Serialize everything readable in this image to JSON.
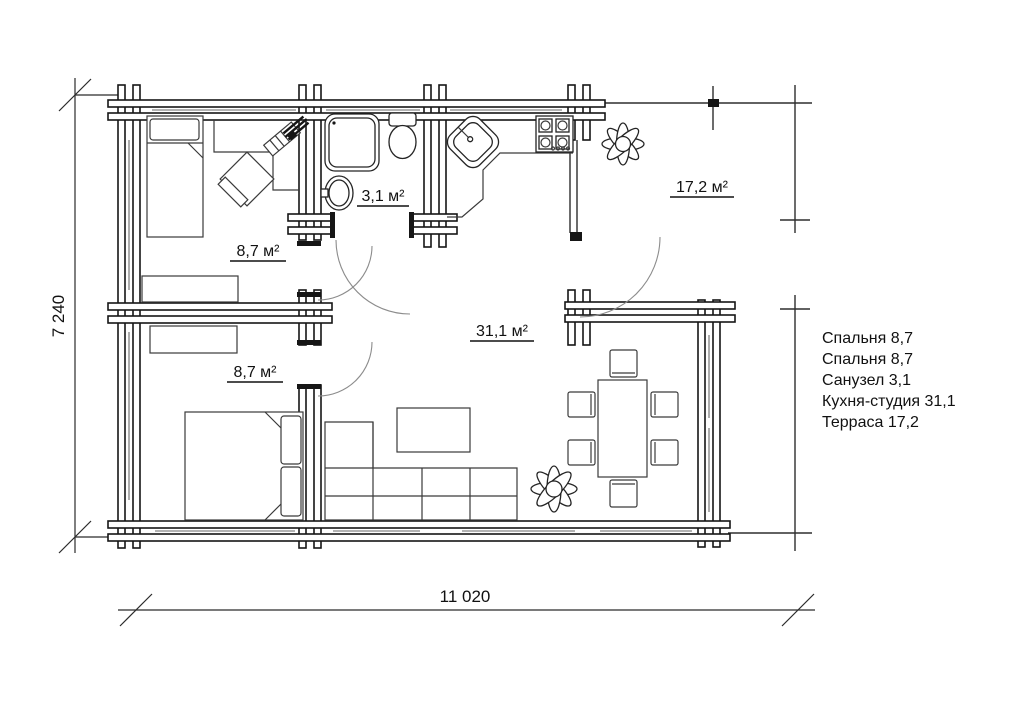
{
  "plan": {
    "room_labels": {
      "bedroom1": "8,7 м²",
      "bathroom": "3,1 м²",
      "bedroom2": "8,7 м²",
      "kitchen_studio": "31,1 м²",
      "terrace": "17,2 м²"
    },
    "dimensions": {
      "height": "7 240",
      "width": "11 020"
    }
  },
  "legend": {
    "items": [
      "Спальня 8,7",
      "Спальня 8,7",
      "Санузел 3,1",
      "Кухня-студия 31,1",
      "Терраса 17,2"
    ]
  },
  "colors": {
    "background": "#ffffff",
    "walls": "#161616",
    "windows": "#9a9a9a",
    "door_arcs": "#8c8c8c",
    "text": "#111111"
  }
}
